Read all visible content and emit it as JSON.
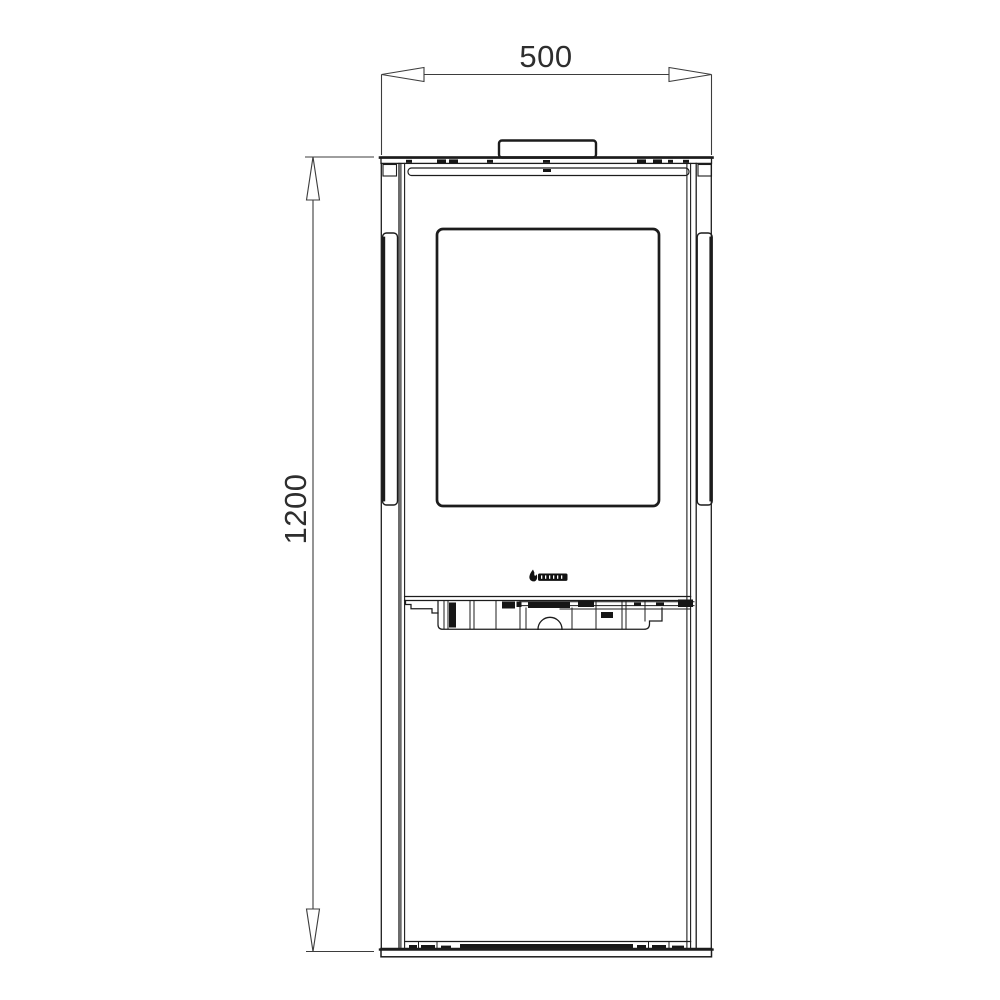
{
  "colors": {
    "background": "#ffffff",
    "line": "#1c1c1c",
    "dimension_line": "#3d3d3d",
    "dimension_text": "#2e2e2e",
    "logo_fill": "#111111"
  },
  "dimensions": {
    "width_label": "500",
    "height_label": "1200"
  },
  "icons": {
    "logo": "flame-logo-icon",
    "width_arrows": "dimension-arrow-horizontal",
    "height_arrows": "dimension-arrow-vertical"
  }
}
